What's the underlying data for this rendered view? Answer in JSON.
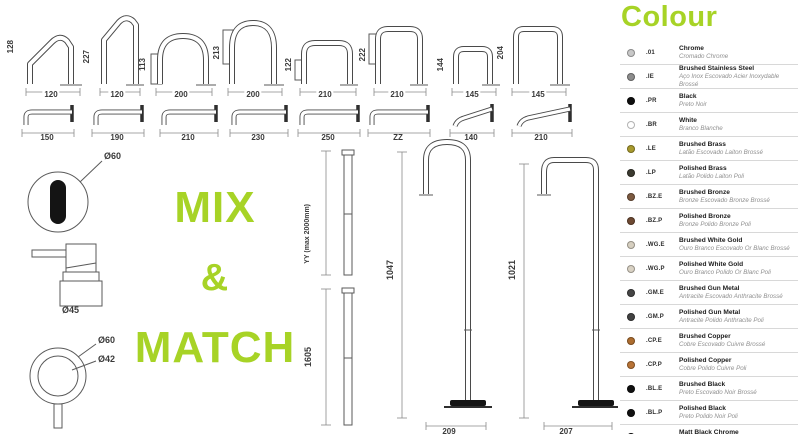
{
  "accent": {
    "green": "#a7d326"
  },
  "mix_match": {
    "line1": "MIX",
    "line2": "&",
    "line3": "MATCH"
  },
  "top_spouts": [
    {
      "height": "128",
      "width": "120"
    },
    {
      "height": "227",
      "width": "120"
    },
    {
      "height": "113",
      "width": "200"
    },
    {
      "height": "213",
      "width": "200"
    },
    {
      "height": "122",
      "width": "210"
    },
    {
      "height": "222",
      "width": "210"
    },
    {
      "height": "144",
      "width": "145"
    },
    {
      "height": "204",
      "width": "145"
    }
  ],
  "wall_spouts": [
    "150",
    "190",
    "210",
    "230",
    "250",
    "ZZ",
    "140",
    "210"
  ],
  "handles": {
    "top_view_dia": "Ø60",
    "side_view_dia": "Ø45",
    "ring_outer_dia": "Ø60",
    "ring_inner_dia": "Ø42"
  },
  "risers": [
    {
      "label": "YY (max 2000mm)"
    },
    {
      "label": "1605"
    }
  ],
  "floor_spouts": [
    {
      "height": "1047",
      "width": "209"
    },
    {
      "height": "1021",
      "width": "207"
    }
  ],
  "colour": {
    "title": "Colour",
    "items": [
      {
        "code": ".01",
        "name": "Chrome",
        "translation": "Cromado Chrome",
        "swatch": "#c8c8c8"
      },
      {
        "code": ".IE",
        "name": "Brushed Stainless Steel",
        "translation": "Aço Inox Escovado Acier Inoxydable Brossé",
        "swatch": "#8d8d8d"
      },
      {
        "code": ".PR",
        "name": "Black",
        "translation": "Preto Noir",
        "swatch": "#0f0f0f"
      },
      {
        "code": ".BR",
        "name": "White",
        "translation": "Branco Blanche",
        "swatch": "#ffffff"
      },
      {
        "code": ".LE",
        "name": "Brushed Brass",
        "translation": "Latão Escovado Laiton Brossé",
        "swatch": "#a89a2e"
      },
      {
        "code": ".LP",
        "name": "Polished Brass",
        "translation": "Latão Polido Laiton Poli",
        "swatch": "#3b3a30"
      },
      {
        "code": ".BZ.E",
        "name": "Brushed Bronze",
        "translation": "Bronze Escovado Bronze Brossé",
        "swatch": "#7c5a41"
      },
      {
        "code": ".BZ.P",
        "name": "Polished Bronze",
        "translation": "Bronze Polido Bronze Poli",
        "swatch": "#6e4a33"
      },
      {
        "code": ".WG.E",
        "name": "Brushed White Gold",
        "translation": "Ouro Branco Escovado Or Blanc Brossé",
        "swatch": "#d6cfc0"
      },
      {
        "code": ".WG.P",
        "name": "Polished White Gold",
        "translation": "Ouro Branco Polido Or Blanc Poli",
        "swatch": "#d9d2c4"
      },
      {
        "code": ".GM.E",
        "name": "Brushed Gun Metal",
        "translation": "Antracite Escovado Anthracite Brossé",
        "swatch": "#454545"
      },
      {
        "code": ".GM.P",
        "name": "Polished Gun Metal",
        "translation": "Antracite Polido Anthracite Poli",
        "swatch": "#424242"
      },
      {
        "code": ".CP.E",
        "name": "Brushed Copper",
        "translation": "Cobre Escovado Cuivre Brossé",
        "swatch": "#ad6d2f"
      },
      {
        "code": ".CP.P",
        "name": "Polished Copper",
        "translation": "Cobre Polido Cuivre Poli",
        "swatch": "#b87336"
      },
      {
        "code": ".BL.E",
        "name": "Brushed Black",
        "translation": "Preto Escovado Noir Brossé",
        "swatch": "#111111"
      },
      {
        "code": ".BL.P",
        "name": "Polished Black",
        "translation": "Preto Polido Noir Poli",
        "swatch": "#111111"
      },
      {
        "code": ".BL.CM",
        "name": "Matt Black Chrome",
        "translation": "Preto Cromado Mate Chrome Noir Mat",
        "swatch": "#111111"
      }
    ]
  }
}
